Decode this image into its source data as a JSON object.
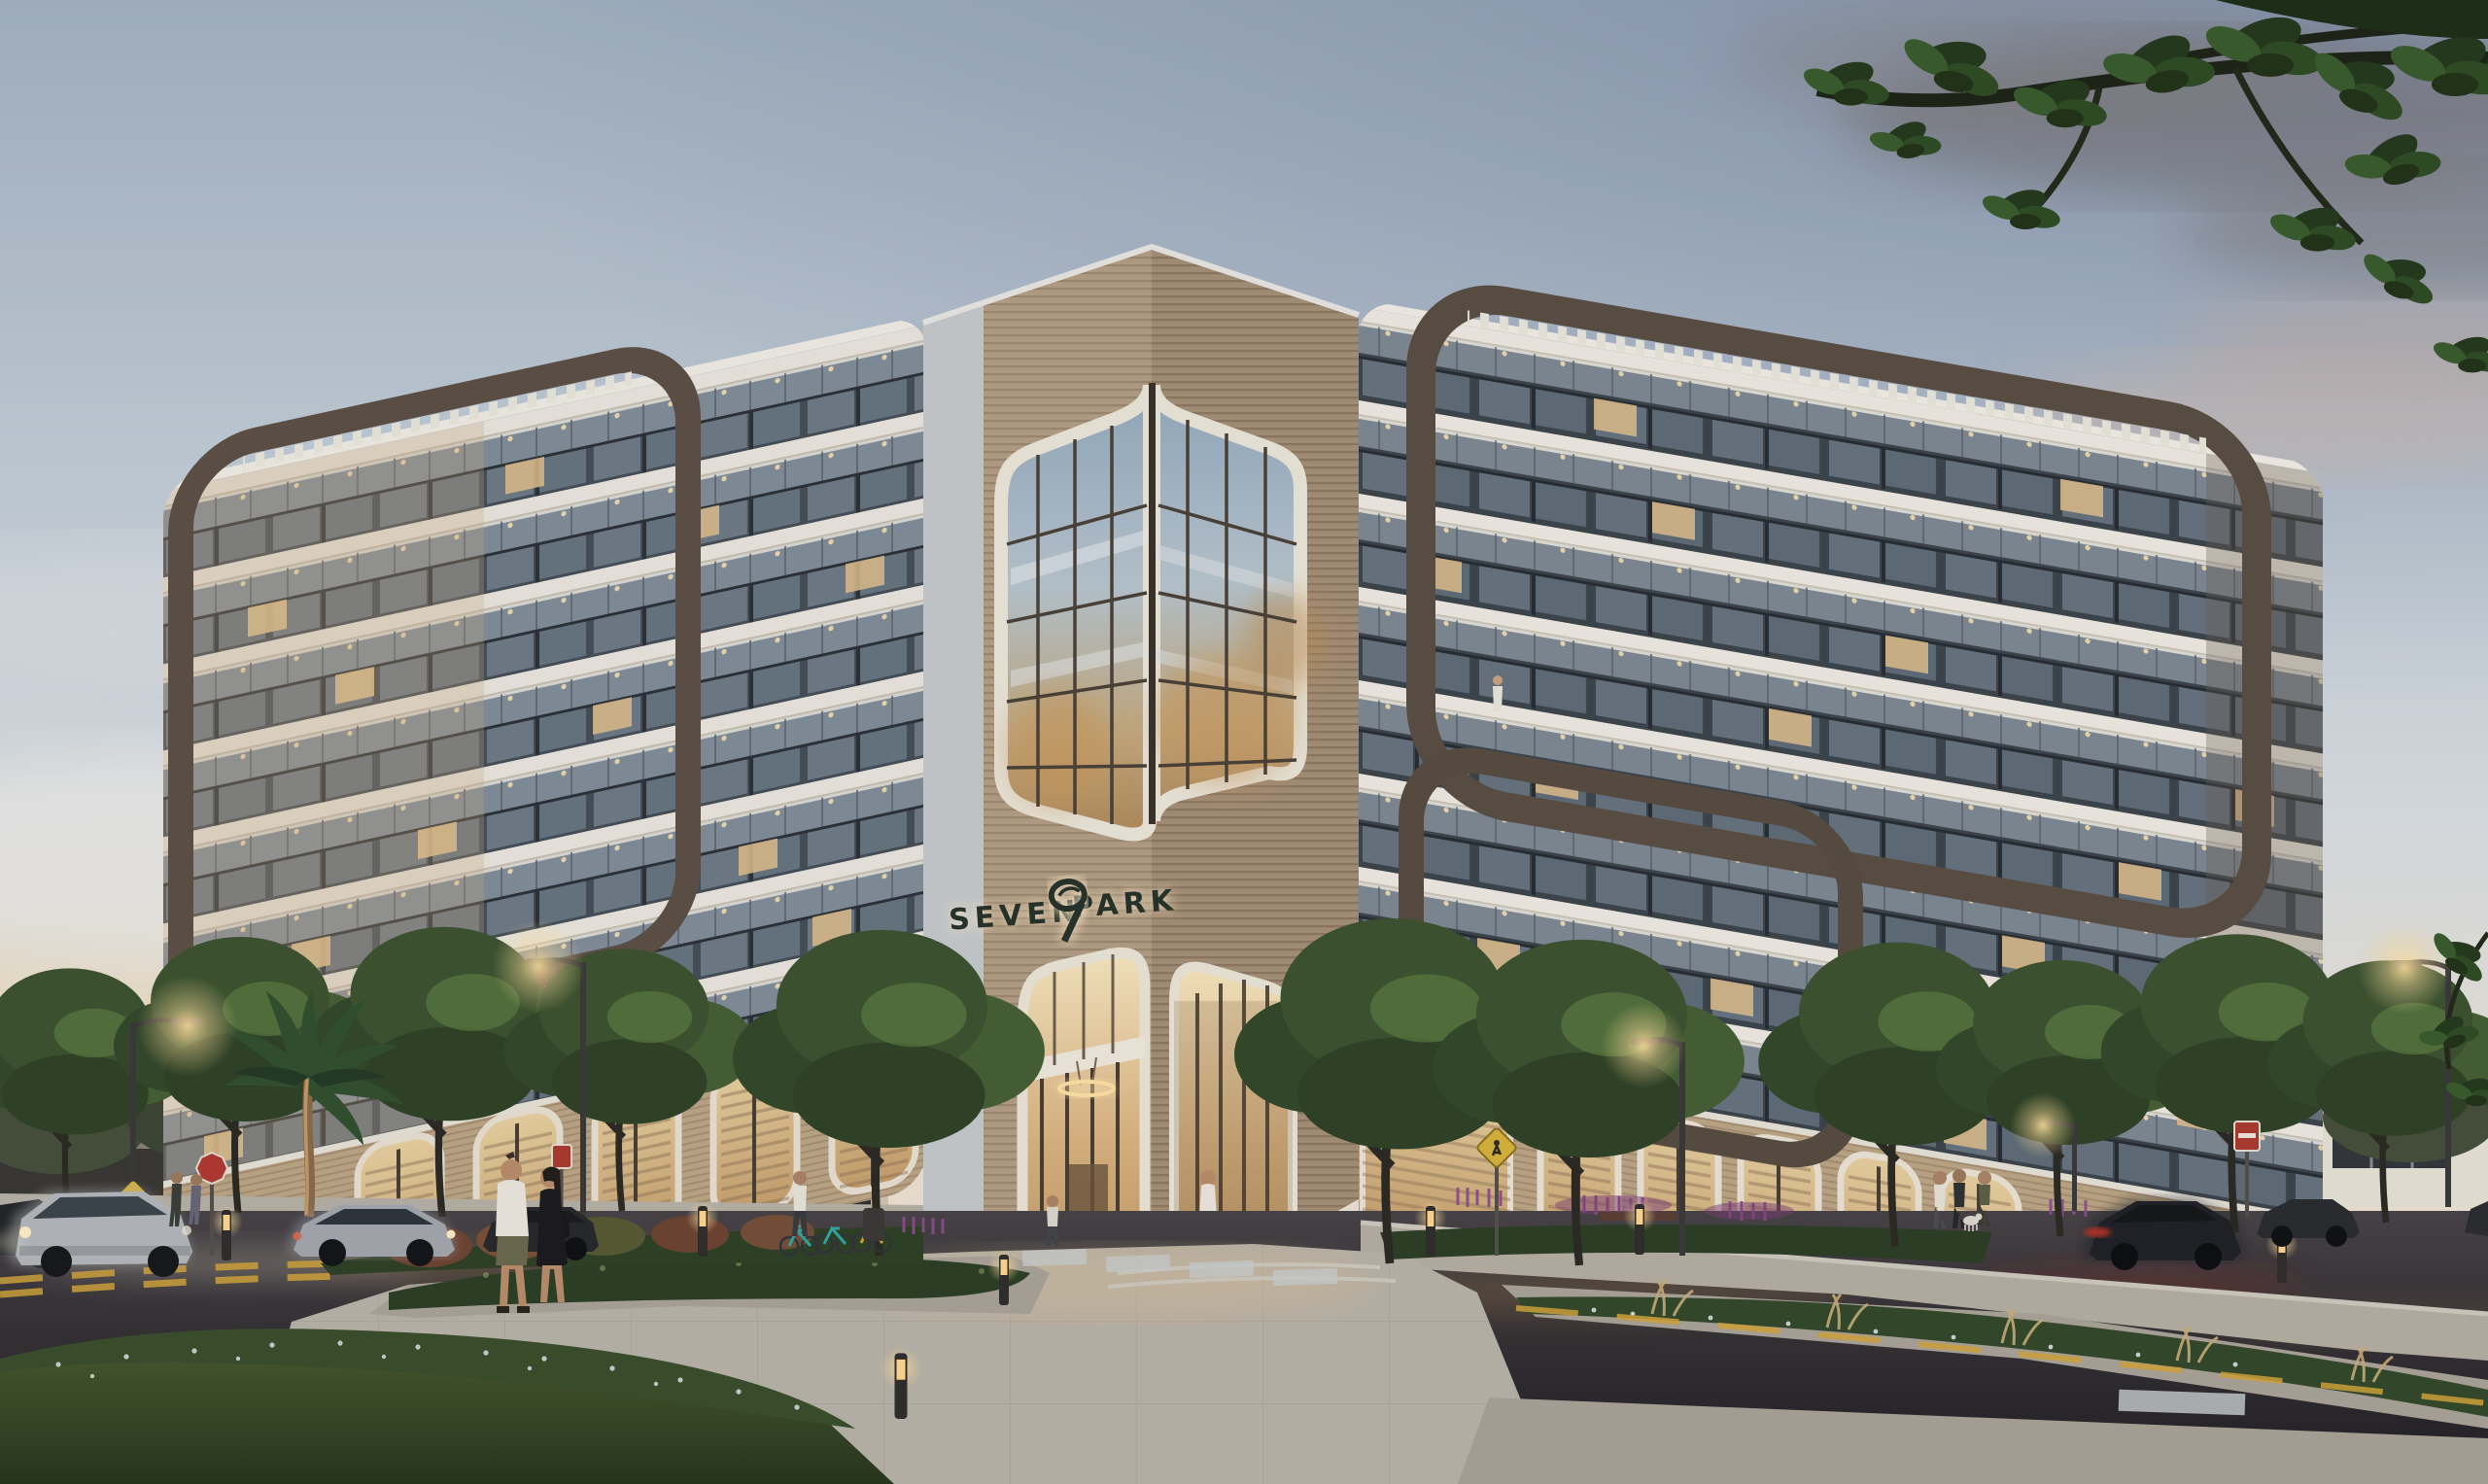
{
  "image": {
    "kind": "architectural exterior rendering",
    "time_of_day": "dusk",
    "subject": "Seven Park condominium building at a street corner"
  },
  "building": {
    "sign": {
      "word_left": "SEVEN",
      "word_right": "PARK",
      "logo": "stylized numeral-7 leaf monogram",
      "sign_color": "#26322a",
      "sign_halo": "#ffeccb"
    },
    "wings": 2,
    "floors_per_wing": 8,
    "features": [
      "corner tower with wood slat cladding",
      "wrap-around rounded glass curtain wall at corner",
      "dark bronze ribbon frames with pergola slats",
      "continuous balconies with glass railings",
      "arched lobby entrance with ring chandelier",
      "arched retail storefronts with wood louvers"
    ]
  },
  "palette": {
    "sky_top": "#9fb2c4",
    "sky_mid": "#d7dde2",
    "horizon_warm": "#f5e3cc",
    "smoke_cloud": "#6e6765",
    "facade_white": "#ece8e0",
    "fascia_tan": "#c7a987",
    "ribbon_bronze": "#5a4f44",
    "wood_light": "#b6a288",
    "wood_dark": "#a8927a",
    "glass_blue": "#8fa5b8",
    "railing_glass": "#a9b9c6",
    "window_dark": "#3f464d",
    "lit_window": "#e3c18d",
    "lobby_glow": "#eed3a0",
    "asphalt": "#35333a",
    "pavement": "#b9b3a8",
    "lawn": "#3a4e2c",
    "hedge": "#2e4126",
    "salvia_purple": "#8e4f8f",
    "grass_tan": "#c9ae7a",
    "tree_green": "#3c5330",
    "streetlight_warm": "#ffd98f",
    "taillight_red": "#c03428",
    "car_silver": "#b9bcc0",
    "car_dark": "#24262b"
  },
  "scene": {
    "vehicles": [
      {
        "name": "silver-suv-moving-left-road"
      },
      {
        "name": "silver-sedan-moving-left-road"
      },
      {
        "name": "dark-sedan-parked-left"
      },
      {
        "name": "dark-car-left-edge"
      },
      {
        "name": "dark-sedan-moving-right-road"
      },
      {
        "name": "dark-car-parked-right"
      },
      {
        "name": "dark-car-right-edge"
      }
    ],
    "people": [
      {
        "name": "couple-walking-foreground"
      },
      {
        "name": "pedestrians-crossing-left"
      },
      {
        "name": "walker-left-sidewalk"
      },
      {
        "name": "walker-near-plaza"
      },
      {
        "name": "man-exiting-lobby"
      },
      {
        "name": "group-with-dog-right-sidewalk"
      },
      {
        "name": "person-on-balcony"
      }
    ],
    "street_elements": [
      {
        "name": "stop-signs",
        "count": 2
      },
      {
        "name": "pedestrian-crossing-signs",
        "count": 2
      },
      {
        "name": "streetlights",
        "count": 5
      },
      {
        "name": "light-bollards",
        "count": 7
      },
      {
        "name": "shared-bikes",
        "count": 3
      },
      {
        "name": "crosswalk"
      },
      {
        "name": "yellow-center-lines"
      }
    ],
    "vegetation": [
      {
        "name": "overhanging-branches-top-right"
      },
      {
        "name": "palm-tree"
      },
      {
        "name": "street-trees"
      },
      {
        "name": "flowering-hedges"
      },
      {
        "name": "purple-salvia-beds"
      },
      {
        "name": "ornamental-grasses"
      }
    ]
  }
}
